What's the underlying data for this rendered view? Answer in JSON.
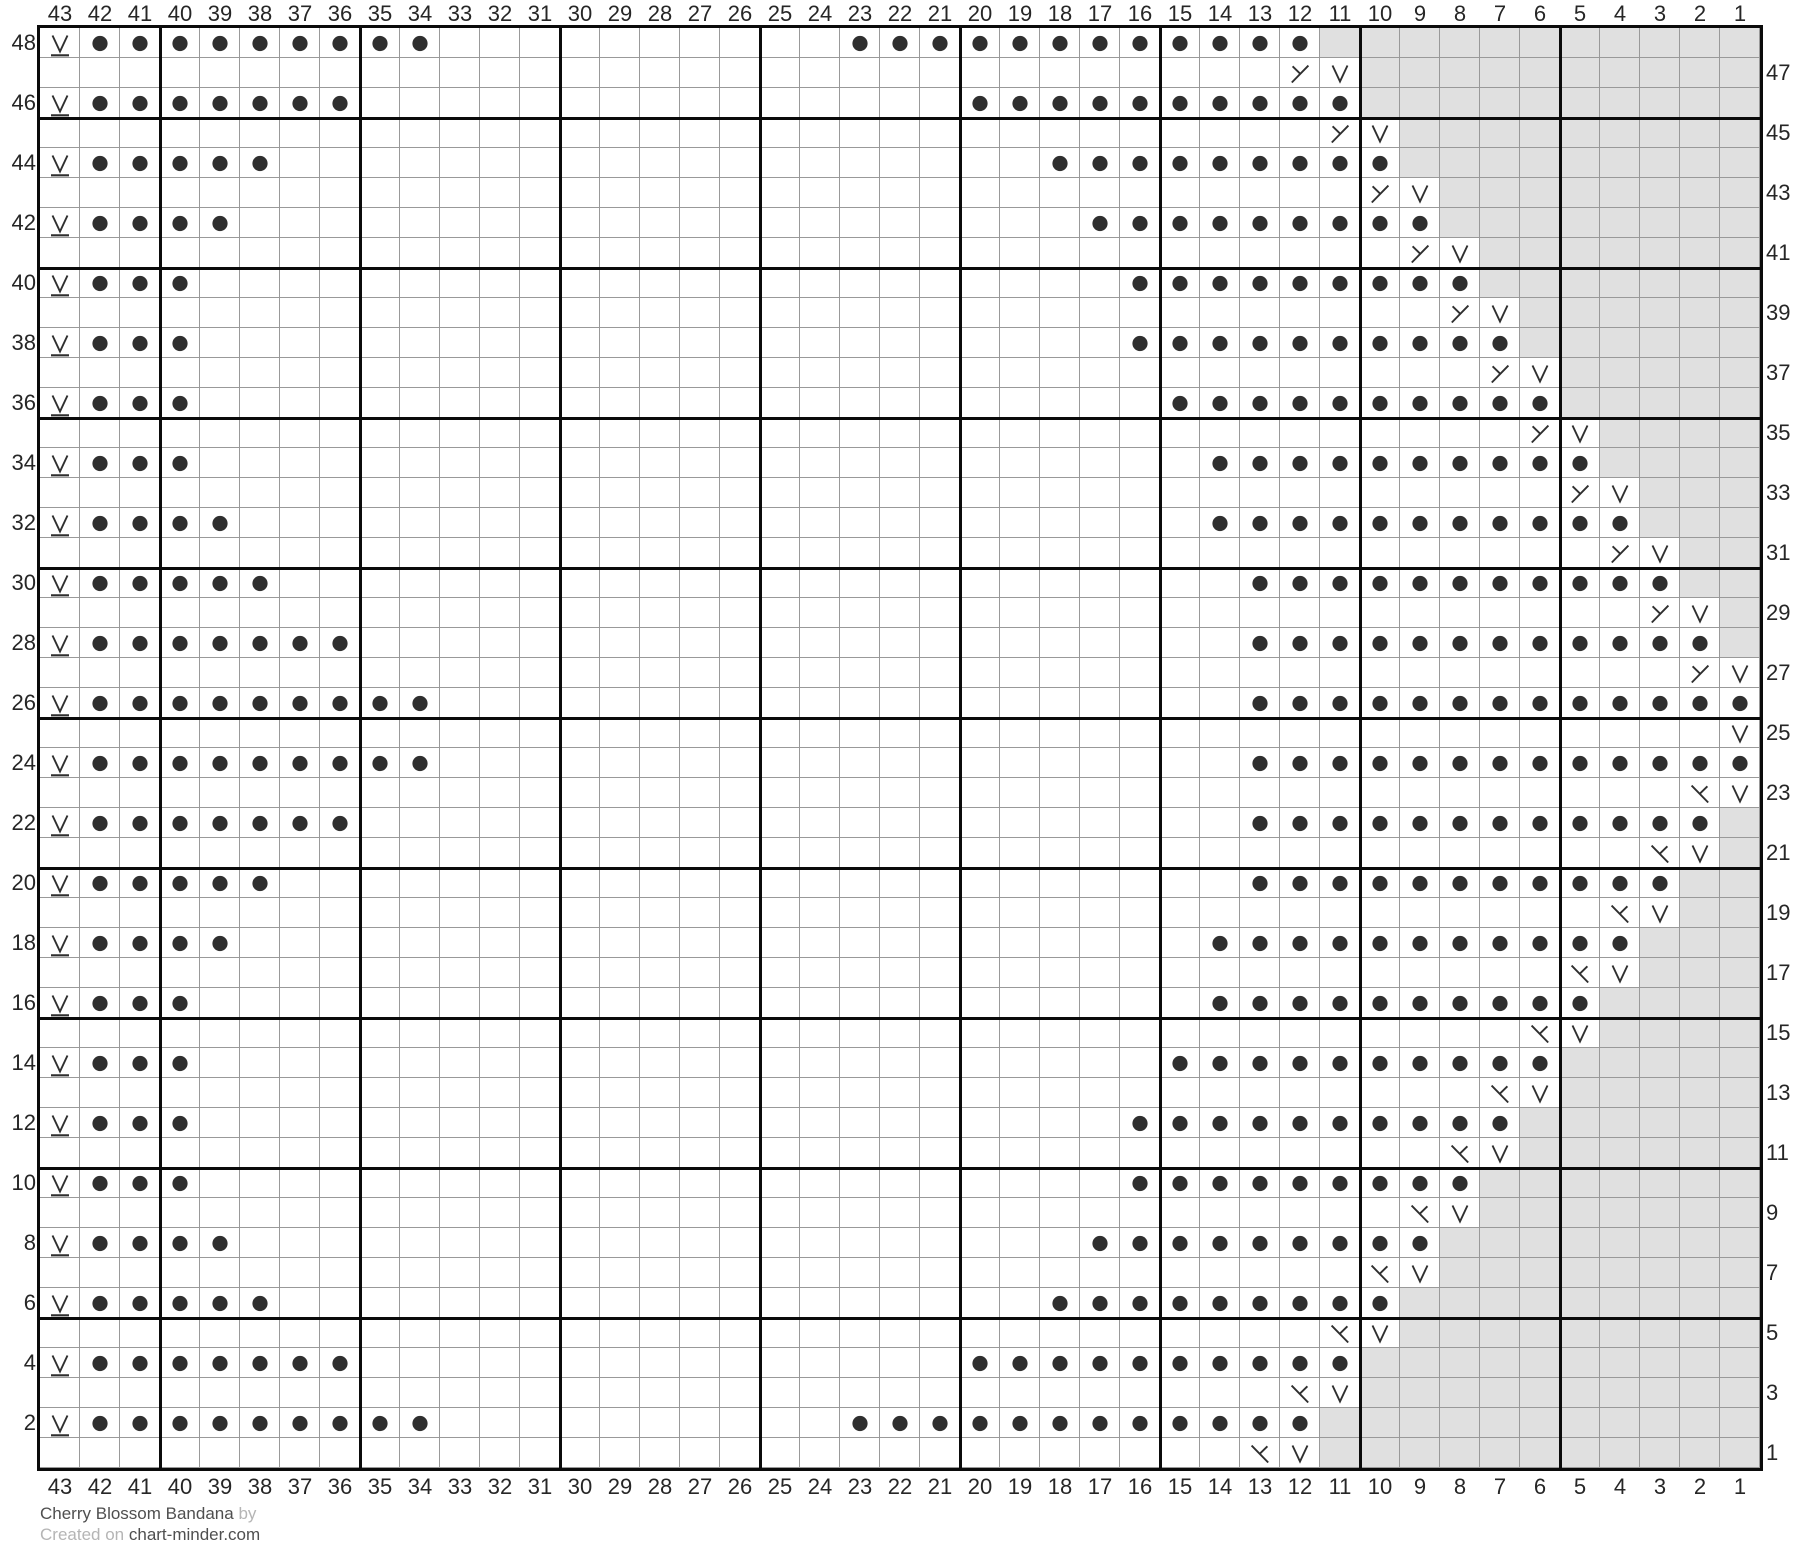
{
  "footer": {
    "title": "Cherry Blossom Bandana",
    "byline": "by",
    "created_prefix": "Created on",
    "site": "chart-minder.com"
  },
  "grid": {
    "columns": 43,
    "rows": 48,
    "column_labels": [
      "43",
      "42",
      "41",
      "40",
      "39",
      "38",
      "37",
      "36",
      "35",
      "34",
      "33",
      "32",
      "31",
      "30",
      "29",
      "28",
      "27",
      "26",
      "25",
      "24",
      "23",
      "22",
      "21",
      "20",
      "19",
      "18",
      "17",
      "16",
      "15",
      "14",
      "13",
      "12",
      "11",
      "10",
      "9",
      "8",
      "7",
      "6",
      "5",
      "4",
      "3",
      "2",
      "1"
    ],
    "left_row_labels": [
      "48",
      "46",
      "44",
      "42",
      "40",
      "38",
      "36",
      "34",
      "32",
      "30",
      "28",
      "26",
      "24",
      "22",
      "20",
      "18",
      "16",
      "14",
      "12",
      "10",
      "8",
      "6",
      "4",
      "2"
    ],
    "right_row_labels": [
      "47",
      "45",
      "43",
      "41",
      "39",
      "37",
      "35",
      "33",
      "31",
      "29",
      "27",
      "25",
      "23",
      "21",
      "19",
      "17",
      "15",
      "13",
      "11",
      "9",
      "7",
      "5",
      "3",
      "1"
    ],
    "symbol_legend": {
      "P": "purl",
      "S": "slip-stitch-underlined",
      "V": "slip-stitch",
      "L": "left-decrease",
      "K": "right-decrease",
      "X": "no-stitch",
      ".": "knit"
    },
    "cells_rle": [
      "S1 P9 .10 P12 X11",
      ".31 L1 V1 X10",
      "S1 P7 .15 P10 X10",
      ".32 L1 V1 X9",
      "S1 P5 .19 P9 X9",
      ".33 L1 V1 X8",
      "S1 P4 .21 P9 X8",
      ".34 L1 V1 X7",
      "S1 P3 .23 P9 X7",
      ".35 L1 V1 X6",
      "S1 P3 .23 P10 X6",
      ".36 L1 V1 X5",
      "S1 P3 .24 P10 X5",
      ".37 L1 V1 X4",
      "S1 P3 .25 P10 X4",
      ".38 L1 V1 X3",
      "S1 P4 .24 P11 X3",
      ".39 L1 V1 X2",
      "S1 P5 .24 P11 X2",
      ".40 L1 V1 X1",
      "S1 P7 .22 P12 X1",
      ".41 L1 V1",
      "S1 P9 .20 P13",
      ".42 V1",
      "S1 P9 .20 P13",
      ".41 K1 V1",
      "S1 P7 .22 P12 X1",
      ".40 K1 V1 X1",
      "S1 P5 .24 P11 X2",
      ".39 K1 V1 X2",
      "S1 P4 .24 P11 X3",
      ".38 K1 V1 X3",
      "S1 P3 .25 P10 X4",
      ".37 K1 V1 X4",
      "S1 P3 .24 P10 X5",
      ".36 K1 V1 X5",
      "S1 P3 .23 P10 X6",
      ".35 K1 V1 X6",
      "S1 P3 .23 P9 X7",
      ".34 K1 V1 X7",
      "S1 P4 .21 P9 X8",
      ".33 K1 V1 X8",
      "S1 P5 .19 P9 X9",
      ".32 K1 V1 X9",
      "S1 P7 .15 P10 X10",
      ".31 K1 V1 X10",
      "S1 P9 .10 P12 X11",
      ".30 K1 V1 X11"
    ]
  },
  "colors": {
    "no_stitch_bg": "#e0e0e0",
    "grid_line": "#999999",
    "grid_line_bold": "#0b0b0b",
    "symbol": "#2f2f2f",
    "label": "#262626",
    "footer_muted": "#b5b5b5",
    "footer_dark": "#4f4f4f"
  }
}
